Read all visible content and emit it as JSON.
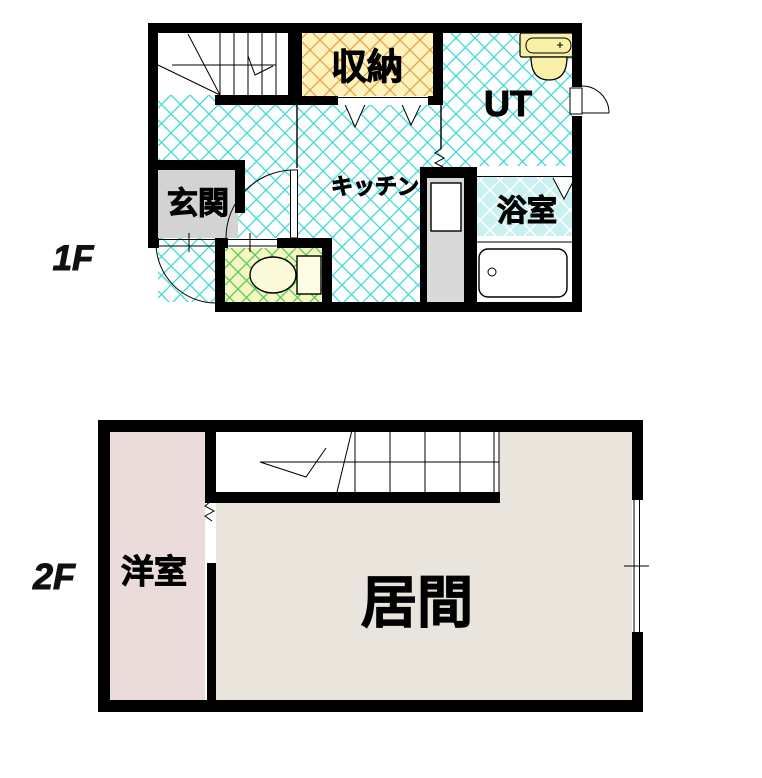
{
  "floor1": {
    "label": "1F",
    "rooms": {
      "storage": "収納",
      "utility": "UT",
      "kitchen": "キッチン",
      "entrance": "玄関",
      "bathroom": "浴室"
    }
  },
  "floor2": {
    "label": "2F",
    "rooms": {
      "western_room": "洋室",
      "living_room": "居間"
    }
  },
  "colors": {
    "wall": "#000000",
    "floor_hatch": "#3fd9d9",
    "storage_bg": "#fdf3bb",
    "storage_hatch": "#e3a24b",
    "toilet_bg": "#f6f6c3",
    "toilet_hatch": "#55cc55",
    "bath_bg": "#c9f1f1",
    "bath_hatch": "#ffffff",
    "bathtub_fill": "#c9f1f5",
    "entrance_bg": "#d3d3d3",
    "counter_bg": "#d9d9d9",
    "sink_fill": "#f8f0a6",
    "western_room_bg": "#ecdbdb",
    "living_room_bg": "#e9e5dc"
  }
}
